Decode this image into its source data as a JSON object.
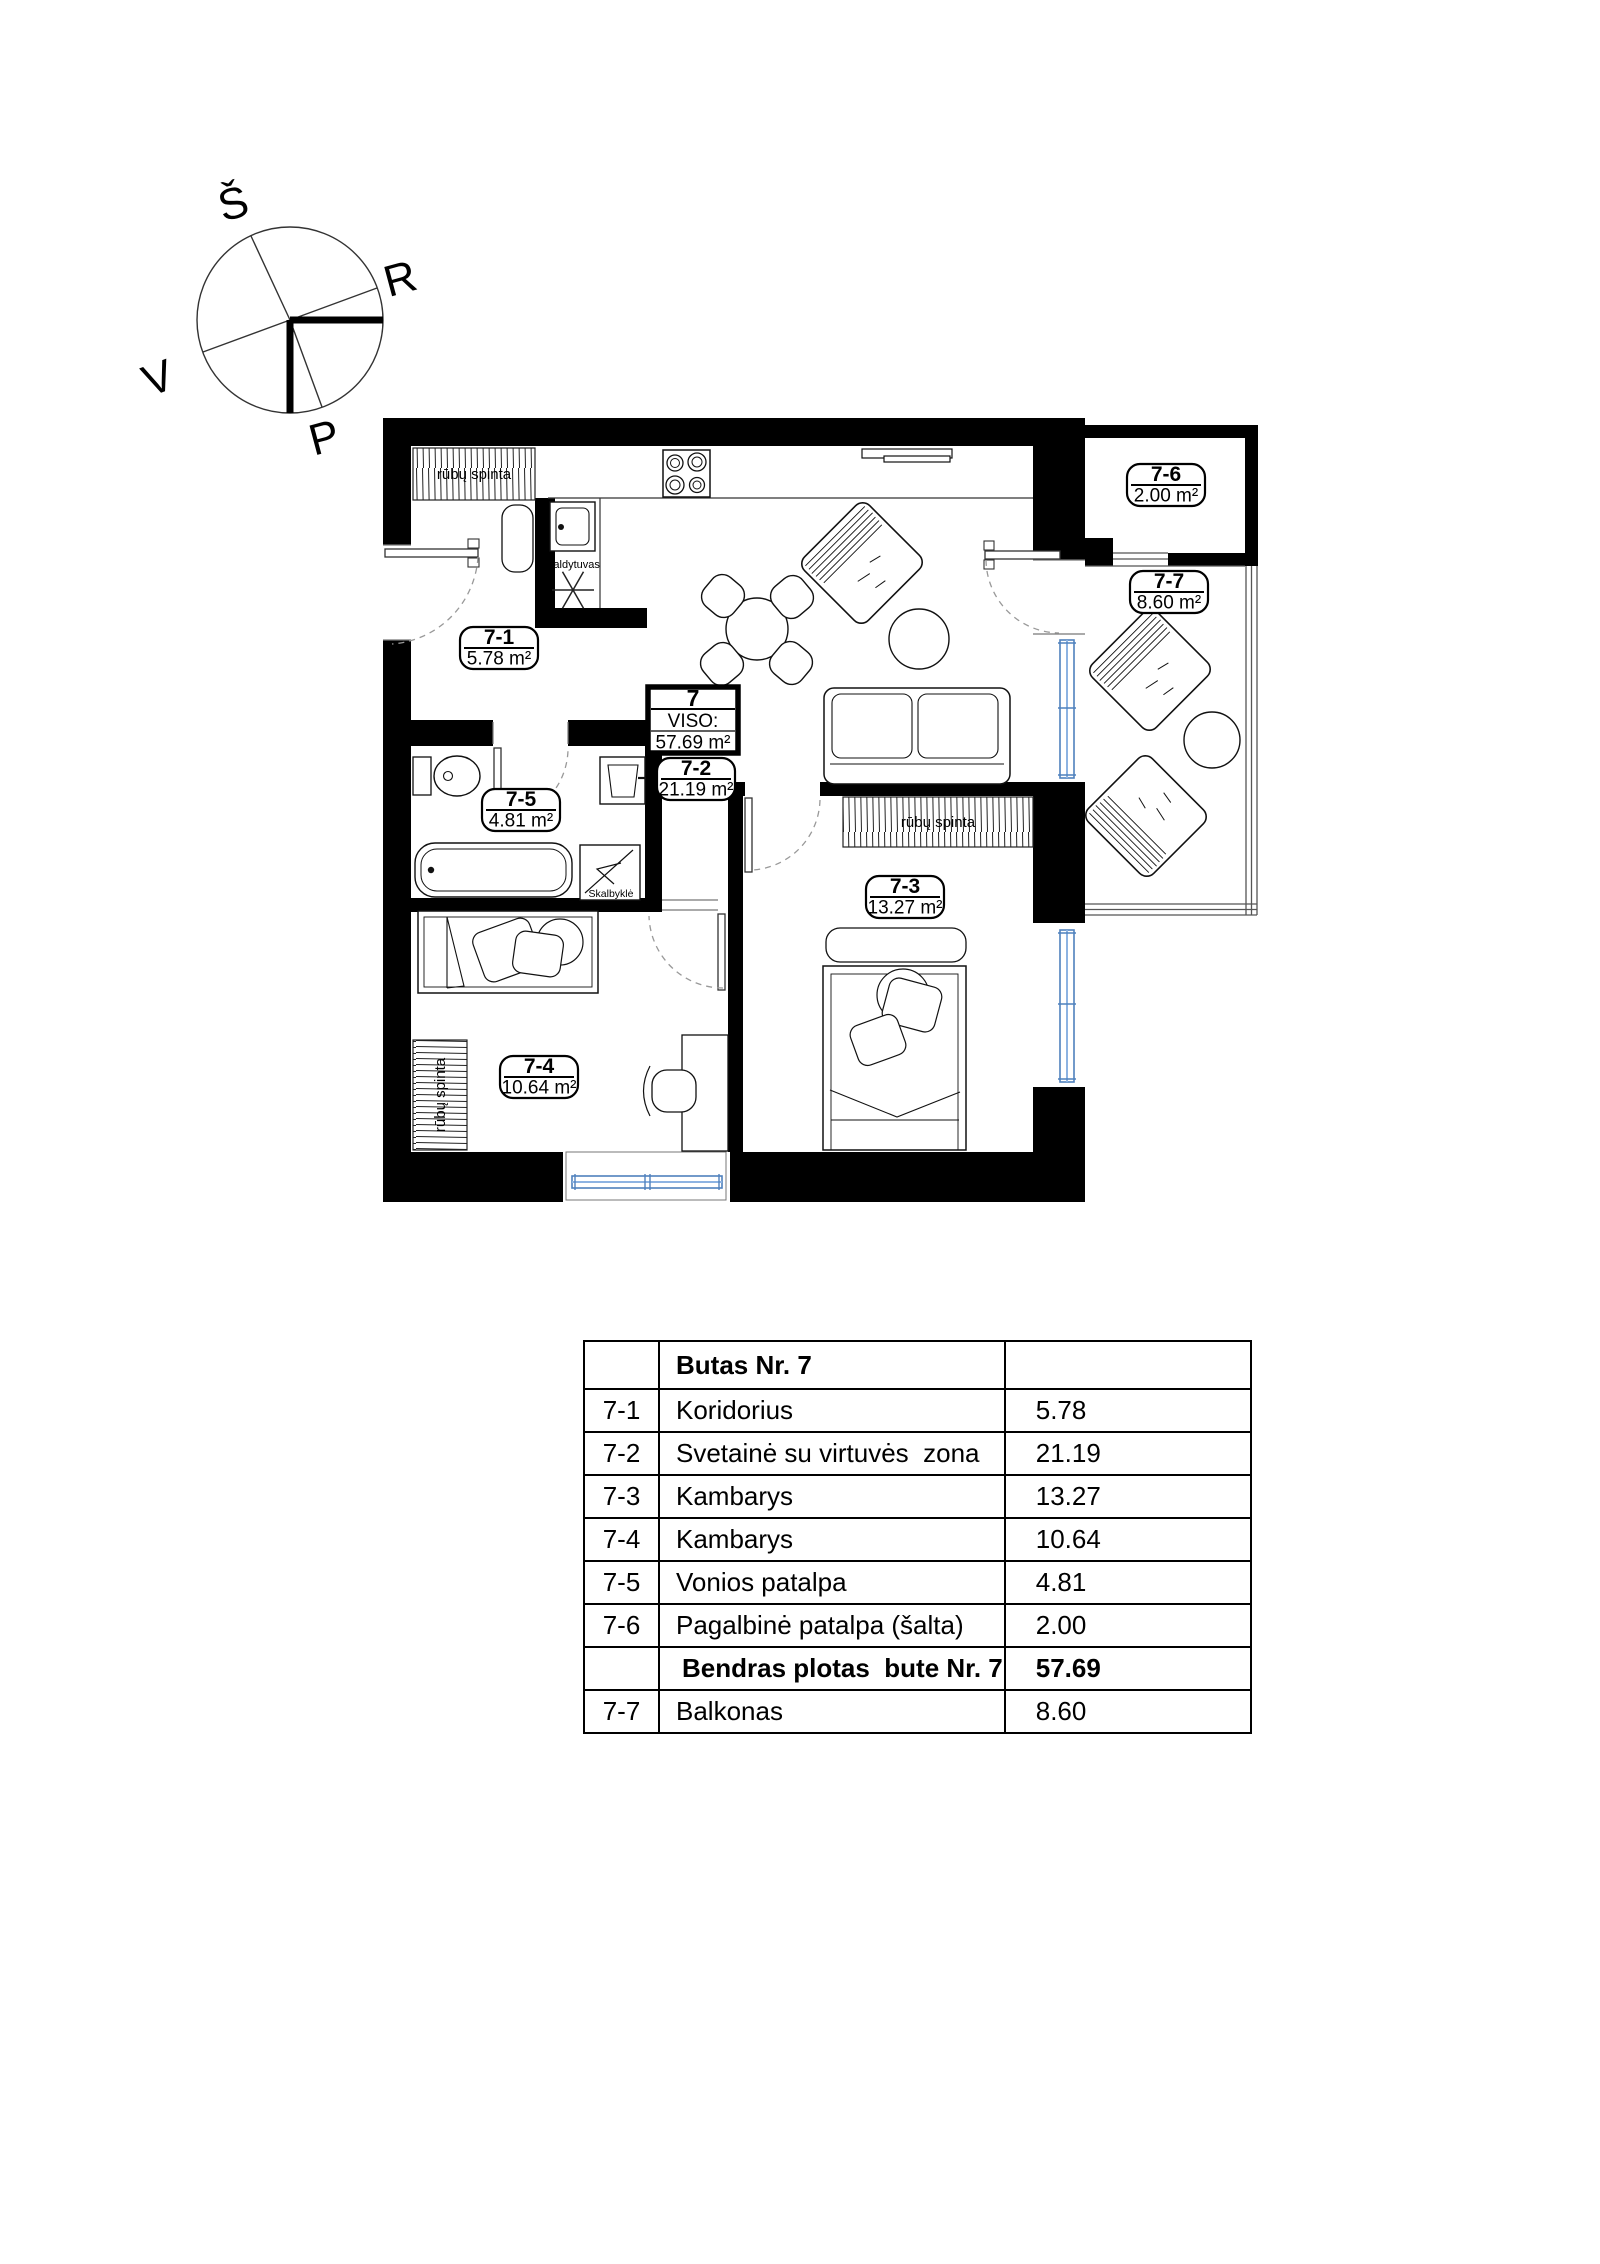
{
  "compass": {
    "north": "Š",
    "east": "R",
    "west": "V",
    "south": "P"
  },
  "plan": {
    "rooms": [
      {
        "id": "7-1",
        "area": "5.78 m²"
      },
      {
        "id": "7-2",
        "area": "21.19 m²"
      },
      {
        "id": "7-3",
        "area": "13.27 m²"
      },
      {
        "id": "7-4",
        "area": "10.64 m²"
      },
      {
        "id": "7-5",
        "area": "4.81 m²"
      },
      {
        "id": "7-6",
        "area": "2.00 m²"
      },
      {
        "id": "7-7",
        "area": "8.60 m²"
      }
    ],
    "total_box": {
      "number": "7",
      "label": "VISO:",
      "area": "57.69 m²"
    },
    "annotations": {
      "wardrobe": "rūbų spinta",
      "fridge": "Šaldytuvas",
      "washer": "Skalbyklė"
    }
  },
  "table": {
    "header": "Butas Nr. 7",
    "rows": [
      {
        "code": "7-1",
        "name": "Koridorius",
        "area": "5.78"
      },
      {
        "code": "7-2",
        "name": "Svetainė su virtuvės  zona",
        "area": "21.19"
      },
      {
        "code": "7-3",
        "name": "Kambarys",
        "area": "13.27"
      },
      {
        "code": "7-4",
        "name": "Kambarys",
        "area": "10.64"
      },
      {
        "code": "7-5",
        "name": "Vonios patalpa",
        "area": "4.81"
      },
      {
        "code": "7-6",
        "name": "Pagalbinė patalpa (šalta)",
        "area": "2.00"
      }
    ],
    "total": {
      "name": "Bendras plotas  bute Nr. 7",
      "area": "57.69"
    },
    "balcony": {
      "code": "7-7",
      "name": "Balkonas",
      "area": "8.60"
    }
  },
  "colors": {
    "wall": "#000000",
    "window": "#4f81bd"
  }
}
